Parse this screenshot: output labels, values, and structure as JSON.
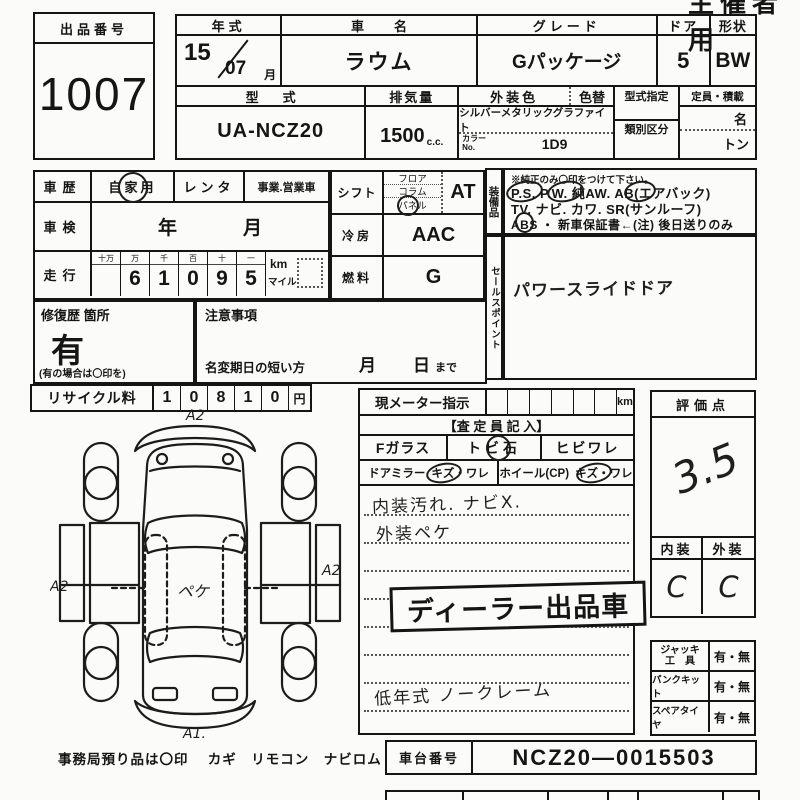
{
  "organizer_label": "主催者用",
  "auction": {
    "label": "出品番号",
    "value": "1007"
  },
  "vehicle": {
    "year_label": "年式",
    "year": "15",
    "month": "07",
    "month_unit": "月",
    "name_label": "車名",
    "name": "ラウム",
    "grade_label": "グレード",
    "grade": "Gパッケージ",
    "door_label": "ドア",
    "door": "5",
    "shape_label": "形状",
    "shape": "BW",
    "model_label": "型式",
    "model": "UA-NCZ20",
    "disp_label": "排気量",
    "disp": "1500",
    "disp_unit": "c.c.",
    "color_label": "外装色",
    "color_change_label": "色替",
    "color": "シルバーメタリックグラファイト",
    "color_no_label1": "カラー",
    "color_no_label2": "No.",
    "color_no": "1D9",
    "type_desig_label": "型式指定",
    "class_label": "類別区分",
    "capacity_label": "定員・積載",
    "capacity_persons_unit": "名",
    "capacity_load_unit": "トン"
  },
  "history": {
    "label": "車歴",
    "private": "自家用",
    "rental": "レンタ",
    "business": "事業.営業車"
  },
  "shaken": {
    "label": "車検",
    "year_unit": "年",
    "month_unit": "月"
  },
  "mileage": {
    "label": "走行",
    "digit_headers": [
      "十万",
      "万",
      "千",
      "百",
      "十",
      "一"
    ],
    "digits": [
      "",
      "6",
      "1",
      "0",
      "9",
      "5"
    ],
    "unit_km": "km",
    "unit_mile": "マイル"
  },
  "repair": {
    "label": "修復歴 箇所",
    "value": "有",
    "note": "(有の場合は〇印を)"
  },
  "caution": {
    "label": "注意事項",
    "name_change": "名変期日の短い方",
    "month": "月",
    "day": "日",
    "until": "まで"
  },
  "shift": {
    "label": "シフト",
    "opt1": "フロア",
    "opt2": "コラム",
    "opt3": "パネル",
    "value": "AT"
  },
  "cooling": {
    "label": "冷房",
    "value": "AAC"
  },
  "fuel": {
    "label": "燃料",
    "value": "G"
  },
  "equipment": {
    "strip_label": "装備品",
    "note": "※純正のみ〇印をつけて下さい。",
    "line1": "P.S.  P.W.  純AW.  AB(エアバック)",
    "line2": "TV. ナビ. カワ. SR(サンルーフ)",
    "line3": "ABS ・ 新車保証書←(注) 後日送りのみ"
  },
  "sales_point": {
    "strip_label": "セールスポイント",
    "value": "パワースライドドア"
  },
  "recycle": {
    "label": "リサイクル料",
    "digits": [
      "1",
      "0",
      "8",
      "1",
      "0"
    ],
    "unit": "円"
  },
  "meter": {
    "label": "現メーター指示",
    "unit": "km",
    "assessor": "【査 定 員 記 入】",
    "front_glass_label": "Fガラス",
    "stone_chip": "トビ石",
    "crack": "ヒビワレ",
    "mirror_label": "ドアミラー",
    "mirror_opt": "キズ・ワレ",
    "wheel_label": "ホイール(CP)",
    "wheel_opt": "キズ・ワレ",
    "note1": "内装汚れ. ナビX.",
    "note2": "外装ペケ",
    "stamp": "ディーラー出品車",
    "claim": "低年式 ノークレーム"
  },
  "evaluation": {
    "label": "評価点",
    "score": "3.5",
    "interior_label": "内装",
    "exterior_label": "外装",
    "interior": "C",
    "exterior": "C"
  },
  "tools": [
    {
      "l1": "ジャッキ",
      "l2": "工　具",
      "value": "有・無"
    },
    {
      "l1": "パンクキット",
      "l2": "",
      "value": "有・無"
    },
    {
      "l1": "スペアタイヤ",
      "l2": "",
      "value": "有・無"
    }
  ],
  "chassis": {
    "label": "車台番号",
    "value": "NCZ20—0015503"
  },
  "deposit_note": "事務局預り品は〇印　 カギ　リモコン　ナビロム",
  "diagram": {
    "front": "A2",
    "left": "A2",
    "right": "A2",
    "rear": "A1.",
    "center": "ペケ"
  }
}
